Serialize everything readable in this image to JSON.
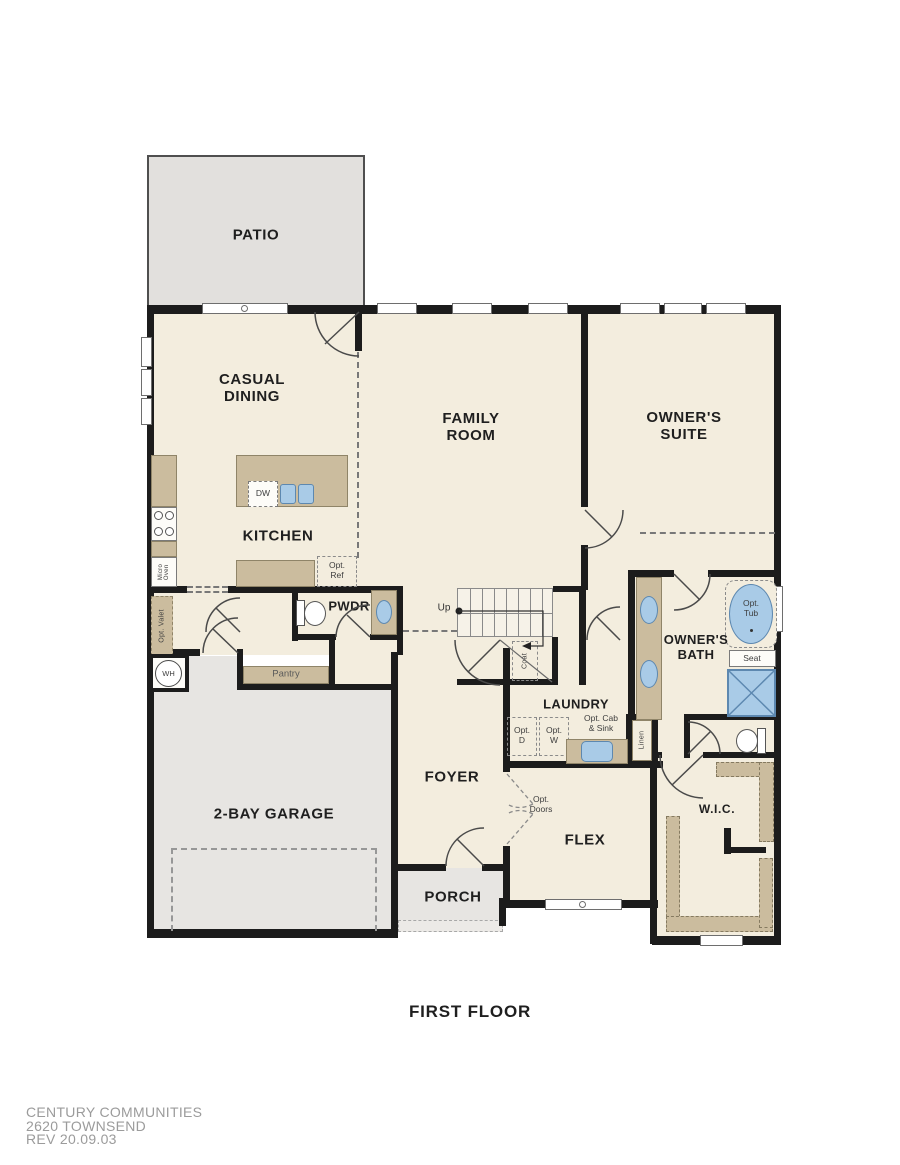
{
  "title": {
    "floor": "FIRST FLOOR"
  },
  "footer": {
    "company": "CENTURY COMMUNITIES",
    "plan": "2620 TOWNSEND",
    "revision": "REV 20.09.03"
  },
  "rooms": {
    "patio": "PATIO",
    "casual_dining": "CASUAL\nDINING",
    "kitchen": "KITCHEN",
    "family_room": "FAMILY\nROOM",
    "owners_suite": "OWNER'S\nSUITE",
    "owners_bath": "OWNER'S\nBATH",
    "pwdr": "PWDR",
    "laundry": "LAUNDRY",
    "foyer": "FOYER",
    "flex": "FLEX",
    "porch": "PORCH",
    "garage": "2-BAY GARAGE",
    "wic": "W.I.C."
  },
  "annotations": {
    "up": "Up",
    "coat": "Coat",
    "pantry": "Pantry",
    "wh": "WH",
    "micro_oven": "Micro\nOven",
    "opt_valet": "Opt. Valet",
    "opt_ref": "Opt.\nRef",
    "dw": "DW",
    "opt_d": "Opt.\nD",
    "opt_w": "Opt.\nW",
    "opt_cab_sink": "Opt. Cab\n& Sink",
    "linen": "Linen",
    "opt_tub": "Opt.\nTub",
    "seat": "Seat",
    "opt_doors": "Opt.\nDoors"
  },
  "colors": {
    "wall": "#1c1c1c",
    "interior": "#f3edde",
    "garage": "#e7e5e2",
    "patio": "#e2e0dd",
    "cabinet": "#cbbc9e",
    "cabinet_border": "#8f8468",
    "fixture_blue": "#a9cbe7",
    "fixture_blue_border": "#5d88b0",
    "label": "#1f1f1f",
    "footer_text": "#9b9b9b"
  }
}
